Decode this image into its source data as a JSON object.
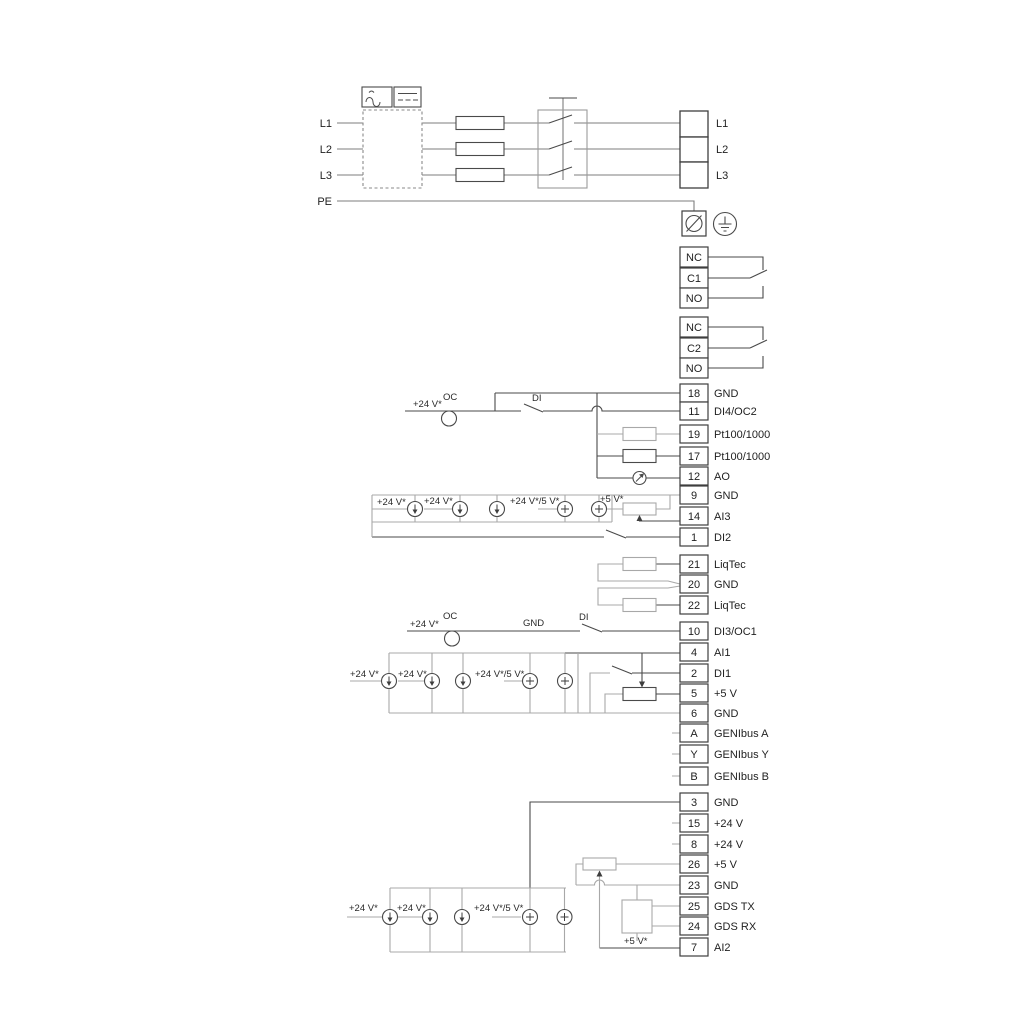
{
  "colors": {
    "dark": "#4a4a4a",
    "gray": "#a8a8a8",
    "power": "#7d7d7d",
    "accent_black": "#3e3e3e"
  },
  "labels": {
    "v24": "+24 V*",
    "v24v5": "+24 V*/5 V*",
    "v5": "+5 V*",
    "oc": "OC",
    "di": "DI",
    "gnd": "GND"
  },
  "mains": {
    "in": [
      "L1",
      "L2",
      "L3",
      "PE"
    ],
    "out": [
      "L1",
      "L2",
      "L3"
    ]
  },
  "relay1": [
    "NC",
    "C1",
    "NO"
  ],
  "relay2": [
    "NC",
    "C2",
    "NO"
  ],
  "io1": [
    {
      "id": "18",
      "label": "GND"
    },
    {
      "id": "11",
      "label": "DI4/OC2"
    },
    {
      "id": "19",
      "label": "Pt100/1000"
    },
    {
      "id": "17",
      "label": "Pt100/1000"
    },
    {
      "id": "12",
      "label": "AO"
    },
    {
      "id": "9",
      "label": "GND"
    },
    {
      "id": "14",
      "label": "AI3"
    },
    {
      "id": "1",
      "label": "DI2"
    }
  ],
  "liqtec": [
    {
      "id": "21",
      "label": "LiqTec"
    },
    {
      "id": "20",
      "label": "GND"
    },
    {
      "id": "22",
      "label": "LiqTec"
    }
  ],
  "io2": [
    {
      "id": "10",
      "label": "DI3/OC1"
    },
    {
      "id": "4",
      "label": "AI1"
    },
    {
      "id": "2",
      "label": "DI1"
    },
    {
      "id": "5",
      "label": "+5 V"
    },
    {
      "id": "6",
      "label": "GND"
    },
    {
      "id": "A",
      "label": "GENIbus A"
    },
    {
      "id": "Y",
      "label": "GENIbus Y"
    },
    {
      "id": "B",
      "label": "GENIbus B"
    }
  ],
  "io3": [
    {
      "id": "3",
      "label": "GND"
    },
    {
      "id": "15",
      "label": "+24 V"
    },
    {
      "id": "8",
      "label": "+24 V"
    },
    {
      "id": "26",
      "label": "+5 V"
    },
    {
      "id": "23",
      "label": "GND"
    },
    {
      "id": "25",
      "label": "GDS TX"
    },
    {
      "id": "24",
      "label": "GDS RX"
    },
    {
      "id": "7",
      "label": "AI2"
    }
  ]
}
